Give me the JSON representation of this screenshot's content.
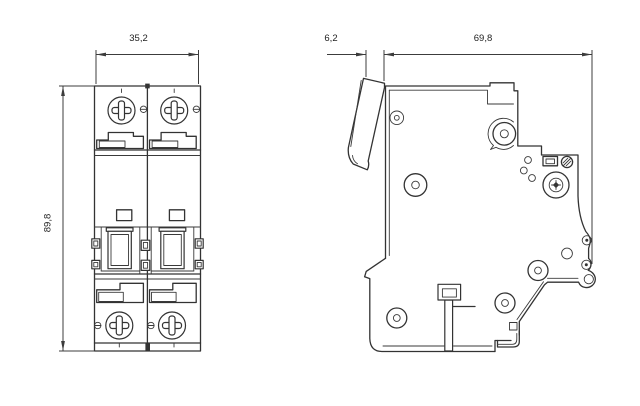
{
  "drawing": {
    "background": "#ffffff",
    "line_color": "#333333",
    "front_view": {
      "width_label": "35,2",
      "height_label": "89,8"
    },
    "side_view": {
      "protrusion_label": "6,2",
      "depth_label": "69,8"
    }
  }
}
